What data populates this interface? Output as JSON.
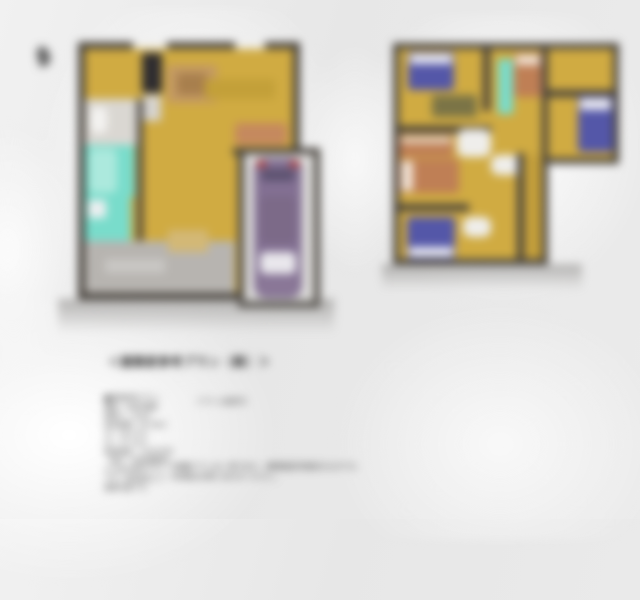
{
  "page": {
    "background": "#e9e9e9",
    "compass_icon": "compass-north-icon"
  },
  "colors": {
    "floor": "#d0ab42",
    "wall": "#46413b",
    "bath_teal": "#79dccb",
    "car_purple": "#837093",
    "taillight_red": "#b8372e",
    "bed_blue": "#5457a8",
    "bed_orange": "#bf7f55",
    "entrance_gray": "#b7b4b0"
  },
  "floor_plans": {
    "first_floor": {
      "rooms": [
        "ldk",
        "bathroom",
        "washroom",
        "entrance",
        "carport"
      ],
      "furniture": [
        "tv-board",
        "counter",
        "dining-set",
        "kitchen-counter",
        "sofa",
        "bathtub",
        "washing-machine",
        "toilet",
        "car"
      ]
    },
    "second_floor": {
      "rooms": [
        "bedroom-1",
        "bedroom-2",
        "bedroom-3",
        "bedroom-4",
        "hall",
        "stairs"
      ],
      "furniture": [
        "bed-blue-1",
        "desk",
        "closet",
        "bed-orange-1",
        "bed-blue-2",
        "dresser",
        "bed-orange-2",
        "bed-blue-3"
      ]
    }
  },
  "caption": {
    "title": "＜建築家参考プラン（案）＞",
    "note": "（プラン変更可）"
  },
  "details": {
    "lines": [
      "■建物参考プラン",
      "構造：木造2階建",
      "間取り：4LDK",
      "延床面積：95.58㎡",
      "1F：48.27㎡",
      "2F：47.31㎡",
      "建物価格：1,650万円",
      "（税込・別途諸費用）",
      "※上記は参考プラン",
      "です。自由設計にて",
      "建築可能です。"
    ]
  },
  "footnotes": [
    "※掲載プランは一例であり、建築確認申請前のものです。",
    "※詳細はお問い合わせください。"
  ]
}
